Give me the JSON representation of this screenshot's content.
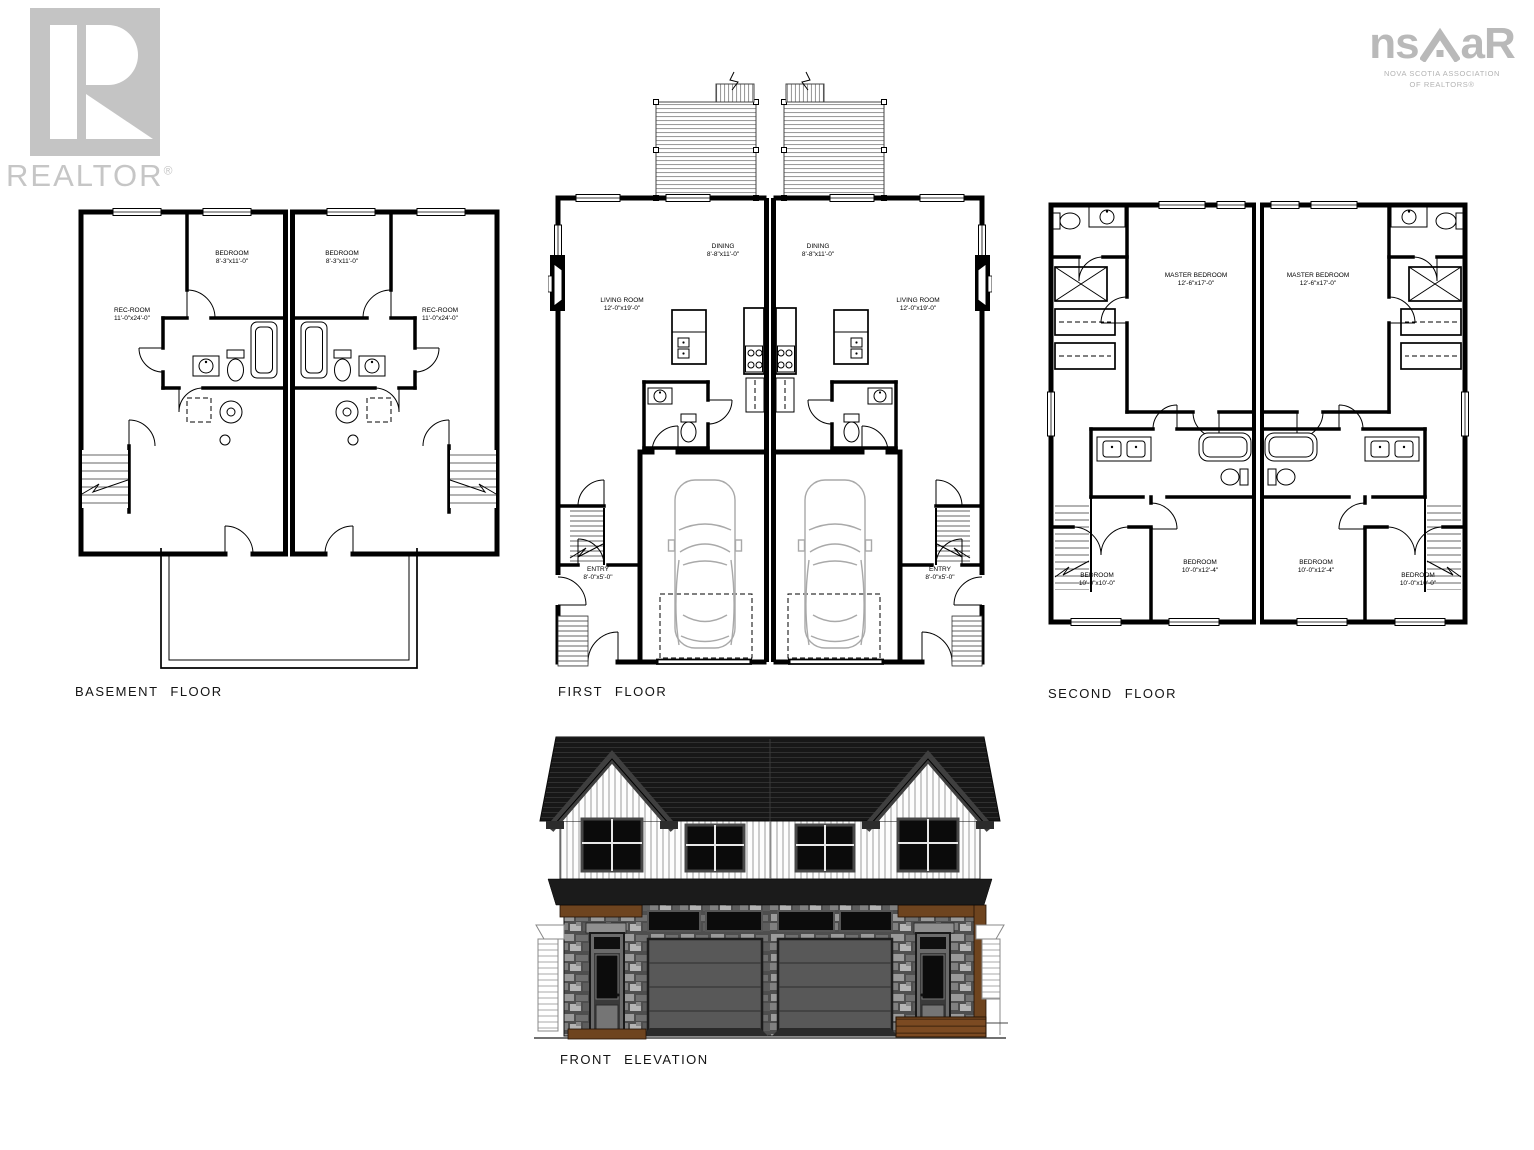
{
  "logos": {
    "realtor": {
      "word": "REALTOR",
      "reg": "®"
    },
    "nsar": {
      "left": "ns",
      "right": "aR",
      "line1": "NOVA SCOTIA ASSOCIATION",
      "line2": "OF REALTORS®"
    }
  },
  "plans": {
    "basement": {
      "title": "BASEMENT FLOOR",
      "rooms": {
        "rec_left": {
          "name": "REC-ROOM",
          "dims": "11'-0\"x24'-0\""
        },
        "bed_left": {
          "name": "BEDROOM",
          "dims": "8'-3\"x11'-0\""
        },
        "bed_right": {
          "name": "BEDROOM",
          "dims": "8'-3\"x11'-0\""
        },
        "rec_right": {
          "name": "REC-ROOM",
          "dims": "11'-0\"x24'-0\""
        }
      }
    },
    "first": {
      "title": "FIRST FLOOR",
      "rooms": {
        "living_left": {
          "name": "LIVING ROOM",
          "dims": "12'-0\"x19'-0\""
        },
        "dining_left": {
          "name": "DINING",
          "dims": "8'-8\"x11'-0\""
        },
        "dining_right": {
          "name": "DINING",
          "dims": "8'-8\"x11'-0\""
        },
        "living_right": {
          "name": "LIVING ROOM",
          "dims": "12'-0\"x19'-0\""
        },
        "entry_left": {
          "name": "ENTRY",
          "dims": "8'-0\"x5'-0\""
        },
        "entry_right": {
          "name": "ENTRY",
          "dims": "8'-0\"x5'-0\""
        }
      }
    },
    "second": {
      "title": "SECOND FLOOR",
      "rooms": {
        "master_left": {
          "name": "MASTER BEDROOM",
          "dims": "12'-6\"x17'-0\""
        },
        "master_right": {
          "name": "MASTER BEDROOM",
          "dims": "12'-6\"x17'-0\""
        },
        "bed_outer_left": {
          "name": "BEDROOM",
          "dims": "10'-0\"x10'-0\""
        },
        "bed_inner_left": {
          "name": "BEDROOM",
          "dims": "10'-0\"x12'-4\""
        },
        "bed_inner_right": {
          "name": "BEDROOM",
          "dims": "10'-0\"x12'-4\""
        },
        "bed_outer_right": {
          "name": "BEDROOM",
          "dims": "10'-0\"x10'-0\""
        }
      }
    },
    "elevation": {
      "title": "FRONT ELEVATION"
    }
  },
  "colors": {
    "drawing_line": "#000000",
    "logo_gray": "#c4c4c4",
    "roof_dark": "#171717",
    "stone_base": "#4e4e4e",
    "garage_door": "#585858",
    "wood_brown": "#6e441f",
    "siding_white": "#fdfdfd"
  }
}
